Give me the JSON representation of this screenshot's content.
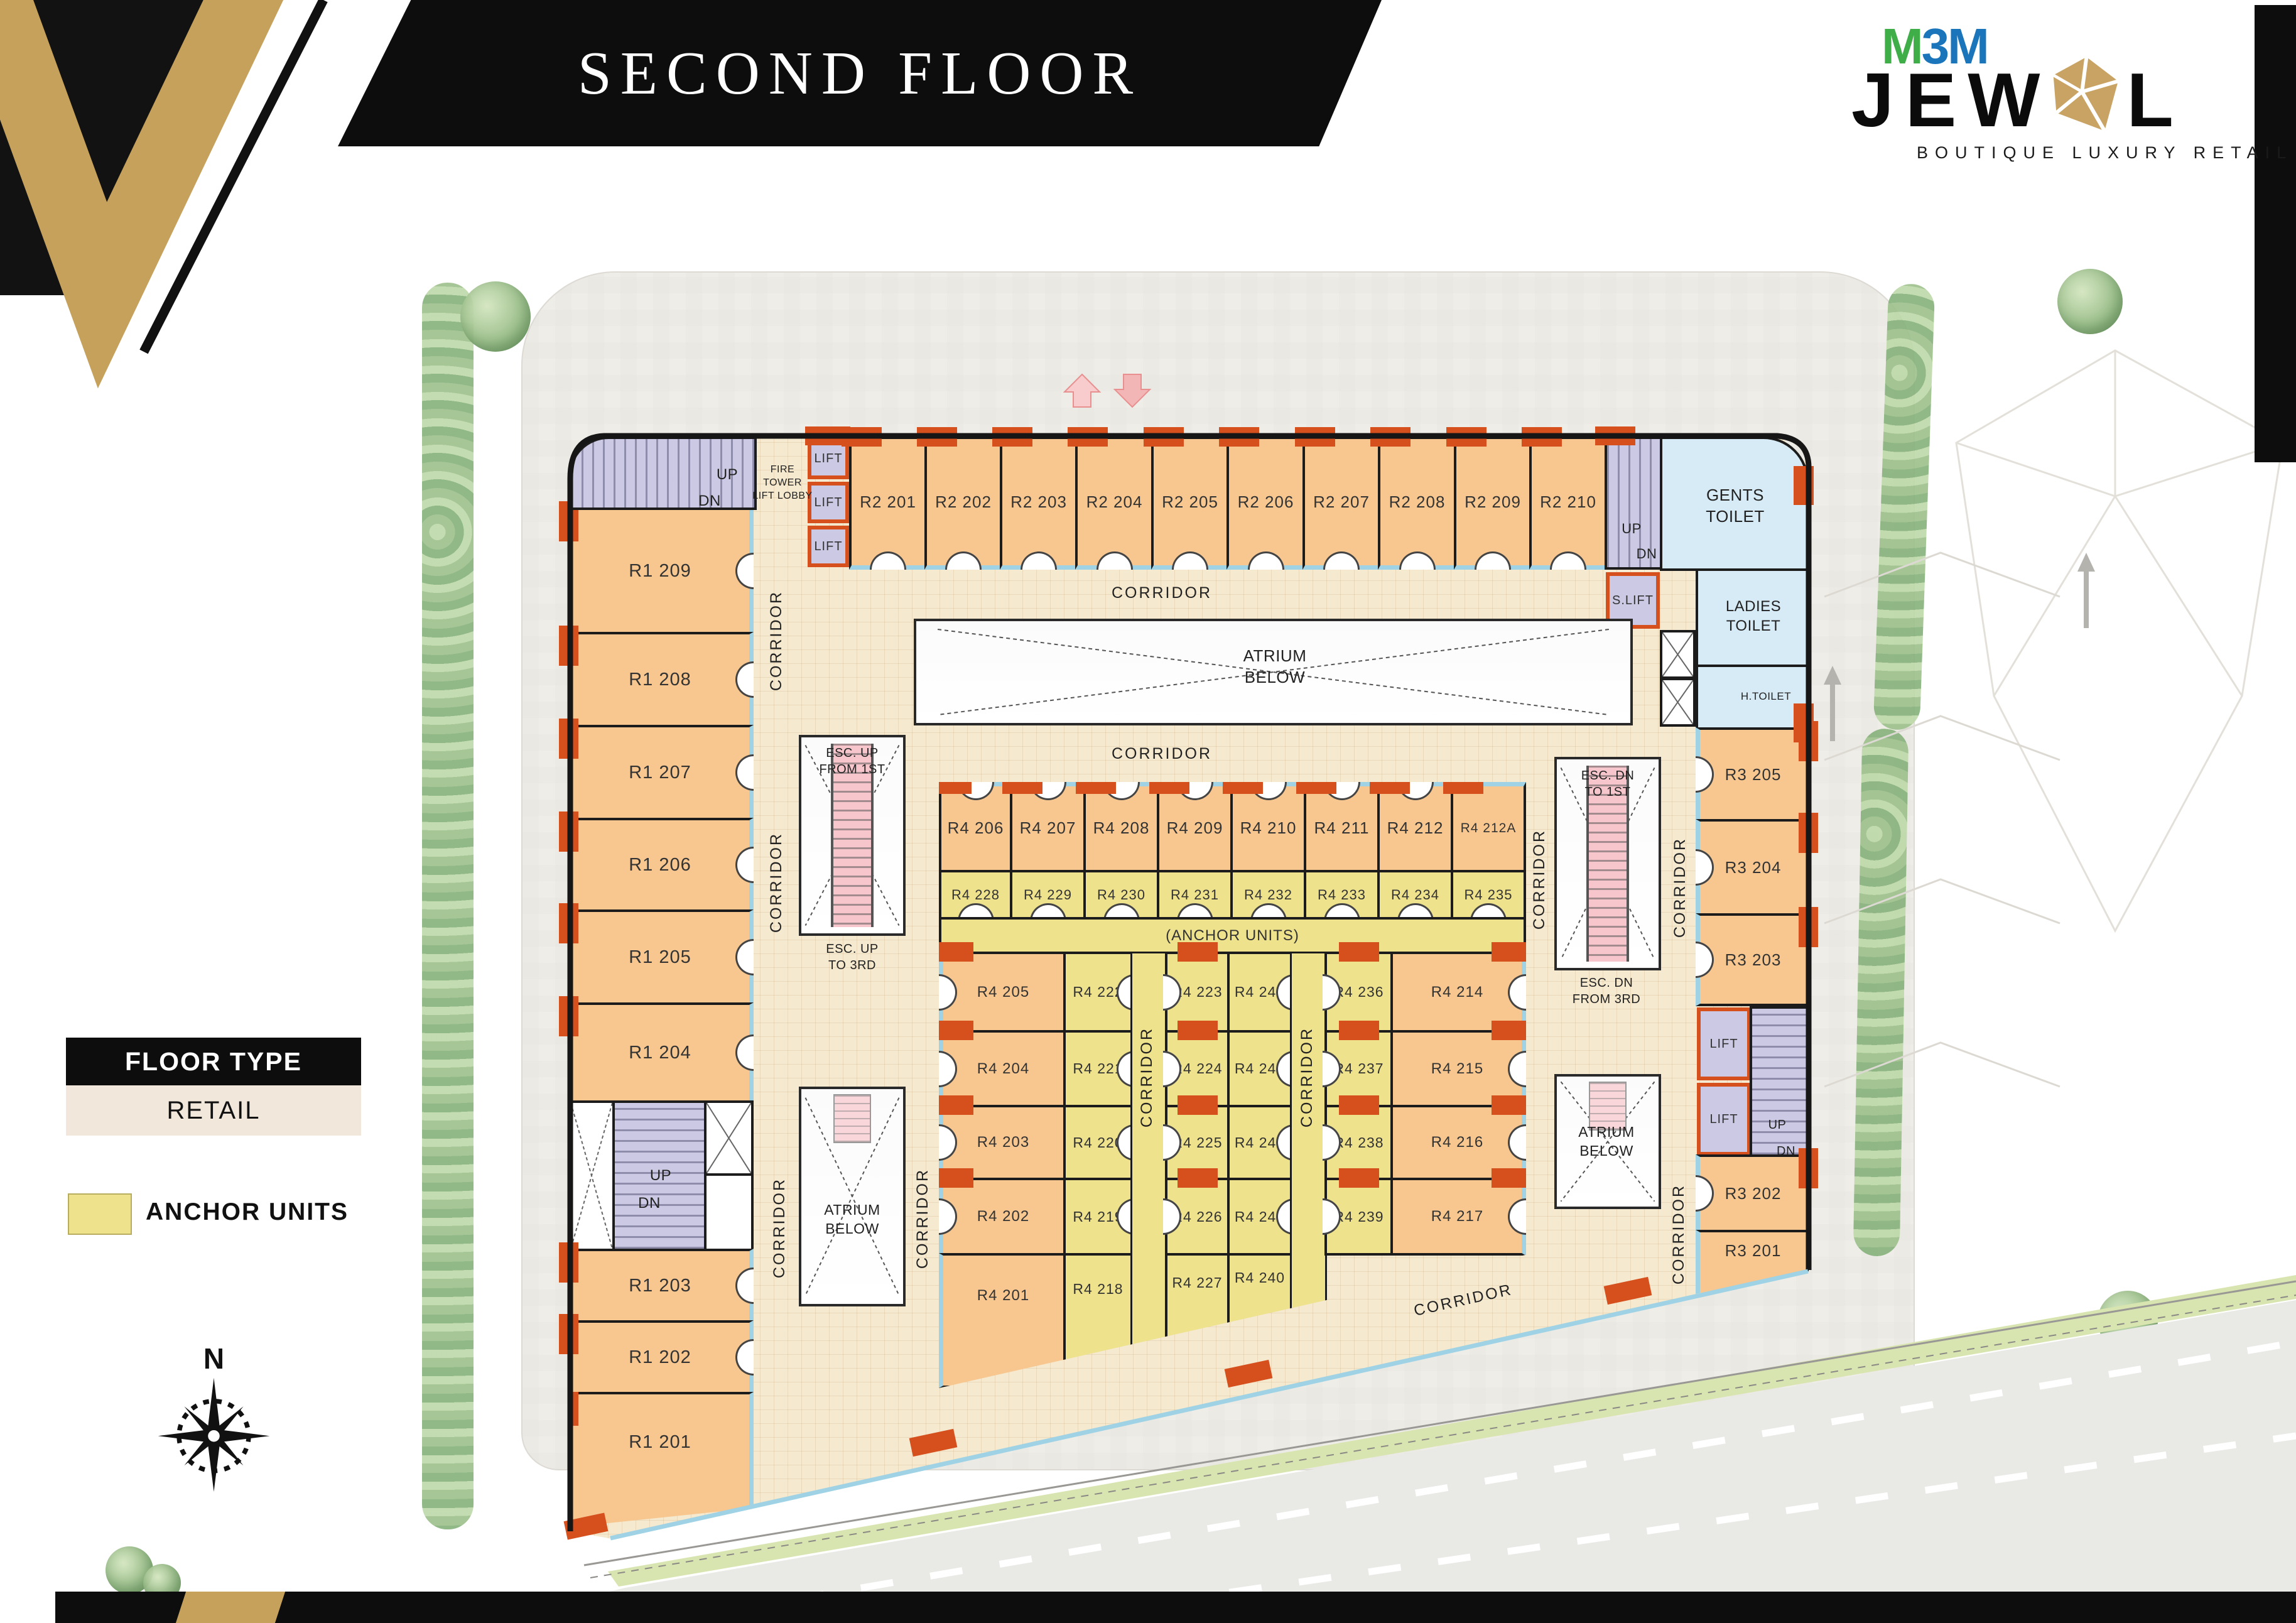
{
  "header": {
    "title": "SECOND FLOOR"
  },
  "logo": {
    "brand_m1": "M",
    "brand_3": "3",
    "brand_m2": "M",
    "name_left": "JEW",
    "name_right": "L",
    "tagline": "BOUTIQUE LUXURY RETAIL"
  },
  "legend": {
    "floor_type": "FLOOR TYPE",
    "retail": "RETAIL",
    "anchor_units": "ANCHOR UNITS"
  },
  "compass": {
    "north": "N"
  },
  "labels": {
    "corridor": "CORRIDOR",
    "atrium_below": "ATRIUM\nBELOW",
    "anchor_units_strip": "(ANCHOR UNITS)",
    "lift": "LIFT",
    "s_lift": "S.LIFT",
    "up": "UP",
    "dn": "DN",
    "fire_tower_lobby": "FIRE TOWER\nLIFT LOBBY",
    "gents_toilet": "GENTS\nTOILET",
    "ladies_toilet": "LADIES\nTOILET",
    "h_toilet": "H.TOILET",
    "esc_up_from_1st": "ESC. UP\nFROM 1ST",
    "esc_up_to_3rd": "ESC. UP\nTO 3RD",
    "esc_dn_to_1st": "ESC. DN\nTO 1ST",
    "esc_dn_from_3rd": "ESC. DN\nFROM 3RD"
  },
  "units": {
    "r1": [
      "R1 209",
      "R1 208",
      "R1 207",
      "R1 206",
      "R1 205",
      "R1 204",
      "R1 203",
      "R1 202",
      "R1 201"
    ],
    "r2": [
      "R2 201",
      "R2 202",
      "R2 203",
      "R2 204",
      "R2 205",
      "R2 206",
      "R2 207",
      "R2 208",
      "R2 209",
      "R2 210"
    ],
    "r3": [
      "R3 205",
      "R3 204",
      "R3 203",
      "R3 202",
      "R3 201"
    ],
    "r4_top": [
      "R4 206",
      "R4 207",
      "R4 208",
      "R4 209",
      "R4 210",
      "R4 211",
      "R4 212",
      "R4 212A"
    ],
    "r4_mid": [
      "R4 228",
      "R4 229",
      "R4 230",
      "R4 231",
      "R4 232",
      "R4 233",
      "R4 234",
      "R4 235"
    ],
    "g1_orange": [
      "R4 205",
      "R4 204",
      "R4 203",
      "R4 202",
      "R4 201"
    ],
    "g1_yellow": [
      "R4 222",
      "R4 221",
      "R4 220",
      "R4 219",
      "R4 218"
    ],
    "g2_left": [
      "R4 223",
      "R4 224",
      "R4 225",
      "R4 226",
      "R4 227"
    ],
    "g2_right": [
      "R4 244",
      "R4 243",
      "R4 242",
      "R4 241",
      "R4 240"
    ],
    "g3_yellow": [
      "R4 236",
      "R4 237",
      "R4 238",
      "R4 239"
    ],
    "g3_orange": [
      "R4 214",
      "R4 215",
      "R4 216",
      "R4 217"
    ]
  },
  "colors": {
    "retail": "#F7C78F",
    "anchor": "#EFE28C",
    "corridor": "#F5E9CF",
    "service": "#CBC9E3",
    "toilet": "#D6EBF5",
    "escalator": "#F6C6CC",
    "column_red": "#D6501E",
    "storefront": "#9ED2E4",
    "gold": "#C6A15B",
    "brand_green": "#3FAE49",
    "brand_blue": "#1B75BB"
  }
}
